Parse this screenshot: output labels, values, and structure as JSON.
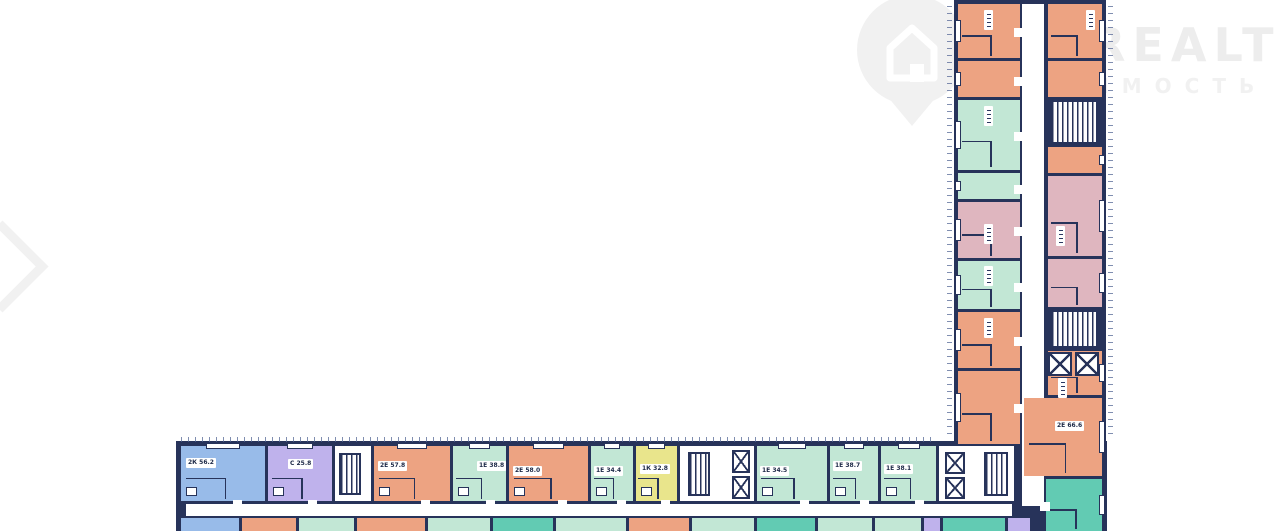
{
  "watermark": {
    "brand": "REALT",
    "subtext": "ИМОСТЬ",
    "icon": "house-pin-icon",
    "color": "#f1f1f1",
    "text_color": "#ededed"
  },
  "floor_plan": {
    "wall_color": "#27335a",
    "palette": {
      "orange": "#eda382",
      "mint": "#c2e7d5",
      "teal": "#62cbb3",
      "blue": "#98bbe9",
      "purple": "#bfb2ec",
      "yellow": "#e9e58c",
      "pink": "#dfb6bf"
    },
    "wings": [
      {
        "x": 176,
        "y": 441,
        "w": 931,
        "h": 90
      },
      {
        "x": 954,
        "y": 0,
        "w": 152,
        "h": 531
      }
    ],
    "corridors": [
      {
        "x": 186,
        "y": 504,
        "w": 826,
        "h": 12
      },
      {
        "x": 1022,
        "y": 4,
        "w": 22,
        "h": 502
      }
    ],
    "units": [
      {
        "x": 181,
        "y": 446,
        "w": 84,
        "h": 55,
        "c": "blue",
        "win": "t"
      },
      {
        "x": 268,
        "y": 446,
        "w": 64,
        "h": 55,
        "c": "purple",
        "win": "t"
      },
      {
        "x": 374,
        "y": 446,
        "w": 76,
        "h": 55,
        "c": "orange",
        "win": "t"
      },
      {
        "x": 453,
        "y": 446,
        "w": 53,
        "h": 55,
        "c": "mint",
        "win": "t"
      },
      {
        "x": 509,
        "y": 446,
        "w": 79,
        "h": 55,
        "c": "orange",
        "win": "t"
      },
      {
        "x": 591,
        "y": 446,
        "w": 42,
        "h": 55,
        "c": "mint",
        "win": "t"
      },
      {
        "x": 636,
        "y": 446,
        "w": 41,
        "h": 55,
        "c": "yellow",
        "win": "t"
      },
      {
        "x": 757,
        "y": 446,
        "w": 70,
        "h": 55,
        "c": "mint",
        "win": "t"
      },
      {
        "x": 830,
        "y": 446,
        "w": 48,
        "h": 55,
        "c": "mint",
        "win": "t"
      },
      {
        "x": 881,
        "y": 446,
        "w": 55,
        "h": 55,
        "c": "mint",
        "win": "t"
      },
      {
        "x": 958,
        "y": 4,
        "w": 62,
        "h": 54,
        "c": "orange",
        "win": "l"
      },
      {
        "x": 958,
        "y": 61,
        "w": 62,
        "h": 36,
        "c": "orange",
        "win": "l"
      },
      {
        "x": 958,
        "y": 100,
        "w": 62,
        "h": 70,
        "c": "mint",
        "win": "l"
      },
      {
        "x": 958,
        "y": 173,
        "w": 62,
        "h": 26,
        "c": "mint",
        "win": "l"
      },
      {
        "x": 958,
        "y": 202,
        "w": 62,
        "h": 56,
        "c": "pink",
        "win": "l"
      },
      {
        "x": 958,
        "y": 261,
        "w": 62,
        "h": 48,
        "c": "mint",
        "win": "l"
      },
      {
        "x": 958,
        "y": 312,
        "w": 62,
        "h": 56,
        "c": "orange",
        "win": "l"
      },
      {
        "x": 958,
        "y": 371,
        "w": 62,
        "h": 73,
        "c": "orange",
        "win": "l"
      },
      {
        "x": 1048,
        "y": 4,
        "w": 54,
        "h": 54,
        "c": "orange",
        "win": "r"
      },
      {
        "x": 1048,
        "y": 61,
        "w": 54,
        "h": 36,
        "c": "orange",
        "win": "r"
      },
      {
        "x": 1048,
        "y": 147,
        "w": 54,
        "h": 26,
        "c": "orange",
        "win": "r"
      },
      {
        "x": 1048,
        "y": 176,
        "w": 54,
        "h": 80,
        "c": "pink",
        "win": "r"
      },
      {
        "x": 1048,
        "y": 259,
        "w": 54,
        "h": 48,
        "c": "pink",
        "win": "r"
      },
      {
        "x": 1048,
        "y": 351,
        "w": 54,
        "h": 44,
        "c": "orange",
        "win": "r"
      },
      {
        "x": 1024,
        "y": 398,
        "w": 78,
        "h": 78,
        "c": "orange",
        "win": "r"
      },
      {
        "x": 1046,
        "y": 479,
        "w": 56,
        "h": 52,
        "c": "teal",
        "win": "r"
      }
    ],
    "bottom_row": [
      {
        "x": 181,
        "w": 58,
        "c": "blue"
      },
      {
        "x": 242,
        "w": 54,
        "c": "orange"
      },
      {
        "x": 299,
        "w": 55,
        "c": "mint"
      },
      {
        "x": 357,
        "w": 68,
        "c": "orange"
      },
      {
        "x": 428,
        "w": 62,
        "c": "mint"
      },
      {
        "x": 493,
        "w": 60,
        "c": "teal"
      },
      {
        "x": 556,
        "w": 70,
        "c": "mint"
      },
      {
        "x": 629,
        "w": 60,
        "c": "orange"
      },
      {
        "x": 692,
        "w": 62,
        "c": "mint"
      },
      {
        "x": 757,
        "w": 58,
        "c": "teal"
      },
      {
        "x": 818,
        "w": 54,
        "c": "mint"
      },
      {
        "x": 875,
        "w": 46,
        "c": "mint"
      },
      {
        "x": 924,
        "w": 16,
        "c": "purple"
      },
      {
        "x": 943,
        "w": 62,
        "c": "teal"
      },
      {
        "x": 1008,
        "w": 22,
        "c": "purple"
      }
    ],
    "cores": [
      {
        "x": 335,
        "y": 446,
        "w": 36,
        "h": 55
      },
      {
        "x": 680,
        "y": 446,
        "w": 74,
        "h": 55
      },
      {
        "x": 939,
        "y": 446,
        "w": 75,
        "h": 55
      }
    ],
    "stairs": [
      {
        "x": 339,
        "y": 453,
        "w": 22,
        "h": 42
      },
      {
        "x": 688,
        "y": 452,
        "w": 22,
        "h": 44
      },
      {
        "x": 984,
        "y": 452,
        "w": 24,
        "h": 44
      },
      {
        "x": 1050,
        "y": 100,
        "w": 48,
        "h": 44
      },
      {
        "x": 1050,
        "y": 310,
        "w": 48,
        "h": 38
      }
    ],
    "elevators": [
      {
        "x": 732,
        "y": 450,
        "w": 18,
        "h": 23
      },
      {
        "x": 732,
        "y": 476,
        "w": 18,
        "h": 23
      },
      {
        "x": 945,
        "y": 452,
        "w": 20,
        "h": 22
      },
      {
        "x": 945,
        "y": 477,
        "w": 20,
        "h": 22
      },
      {
        "x": 1048,
        "y": 352,
        "w": 24,
        "h": 24
      },
      {
        "x": 1075,
        "y": 352,
        "w": 24,
        "h": 24
      }
    ],
    "labels": [
      {
        "t": "2К 56.2",
        "x": 186,
        "y": 458
      },
      {
        "t": "С 25.8",
        "x": 288,
        "y": 459
      },
      {
        "t": "2Е 57.8",
        "x": 378,
        "y": 461
      },
      {
        "t": "1Е 38.8",
        "x": 477,
        "y": 461
      },
      {
        "t": "2Е 58.0",
        "x": 513,
        "y": 466
      },
      {
        "t": "1Е 34.4",
        "x": 594,
        "y": 466
      },
      {
        "t": "1К 32.8",
        "x": 640,
        "y": 464
      },
      {
        "t": "1Е 34.5",
        "x": 760,
        "y": 466
      },
      {
        "t": "1Е 38.7",
        "x": 833,
        "y": 461
      },
      {
        "t": "1Е 38.1",
        "x": 884,
        "y": 464
      },
      {
        "t": "2Е 66.6",
        "x": 1055,
        "y": 421
      }
    ],
    "chips": [
      {
        "x": 984,
        "y": 10
      },
      {
        "x": 1086,
        "y": 10
      },
      {
        "x": 984,
        "y": 106
      },
      {
        "x": 984,
        "y": 224
      },
      {
        "x": 1056,
        "y": 226
      },
      {
        "x": 984,
        "y": 266
      },
      {
        "x": 984,
        "y": 318
      },
      {
        "x": 1058,
        "y": 378
      }
    ],
    "ticks": [
      {
        "x": 181,
        "y": 437,
        "w": 755,
        "h": 5,
        "d": "h"
      },
      {
        "x": 947,
        "y": 6,
        "w": 5,
        "h": 428,
        "d": "v"
      },
      {
        "x": 1108,
        "y": 6,
        "w": 5,
        "h": 428,
        "d": "v"
      }
    ]
  }
}
